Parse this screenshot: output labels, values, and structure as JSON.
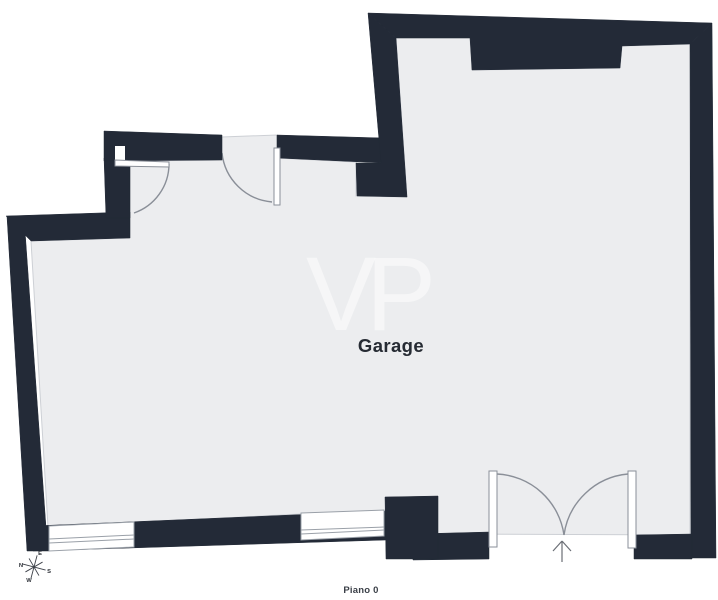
{
  "floor_plan": {
    "room_label": "Garage",
    "level_label": "Piano 0",
    "watermark": "VP",
    "compass": {
      "n": "N",
      "e": "E",
      "s": "S",
      "w": "W"
    }
  },
  "colors": {
    "wall": "#232A37",
    "floor": "#ECEDEF",
    "line": "#8A8F98",
    "text": "#262B33"
  }
}
